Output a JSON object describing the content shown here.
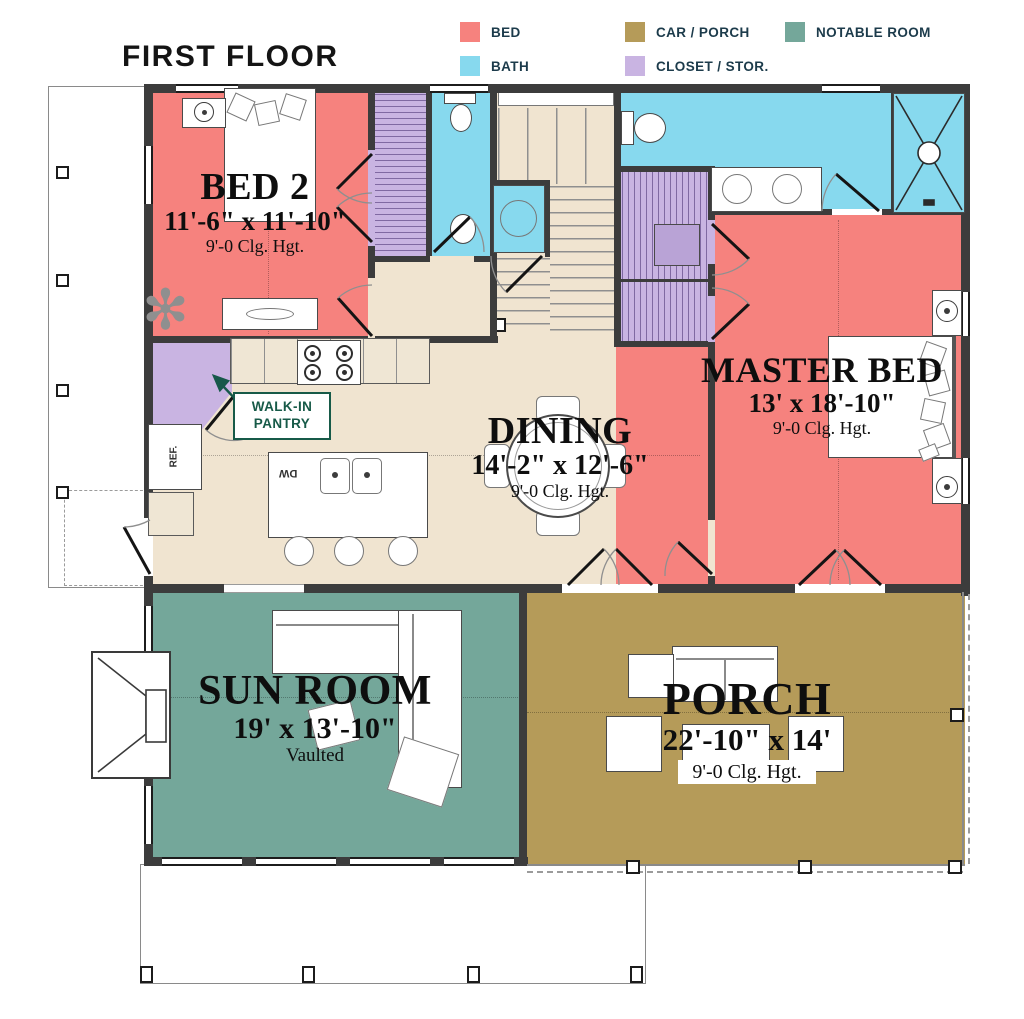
{
  "title": "FIRST FLOOR",
  "legend": {
    "items": [
      {
        "label": "BED"
      },
      {
        "label": "BATH"
      },
      {
        "label": "CAR / PORCH"
      },
      {
        "label": "CLOSET / STOR."
      },
      {
        "label": "NOTABLE ROOM"
      }
    ]
  },
  "rooms": {
    "bed2": {
      "name": "BED 2",
      "dims": "11'-6\" x 11'-10\"",
      "note": "9'-0 Clg. Hgt."
    },
    "master": {
      "name": "MASTER BED",
      "dims": "13' x 18'-10\"",
      "note": "9'-0 Clg. Hgt."
    },
    "dining": {
      "name": "DINING",
      "dims": "14'-2\" x 12'-6\"",
      "note": "9'-0 Clg. Hgt."
    },
    "sunroom": {
      "name": "SUN ROOM",
      "dims": "19' x 13'-10\"",
      "note": "Vaulted"
    },
    "porch": {
      "name": "PORCH",
      "dims": "22'-10\" x 14'",
      "note": "9'-0 Clg. Hgt."
    }
  },
  "annotations": {
    "pantry_line1": "WALK-IN",
    "pantry_line2": "PANTRY",
    "fridge": "REF.",
    "dishwasher": "DW"
  },
  "colors": {
    "bed": "#F6827E",
    "bath": "#87D9EE",
    "car_porch": "#B59B59",
    "closet": "#C9B4E2",
    "notable": "#74A79A",
    "floor": "#F0E4D0",
    "wall": "#3C3C3C",
    "legend_text": "#1C3B4B",
    "pantry_text": "#175A48"
  }
}
